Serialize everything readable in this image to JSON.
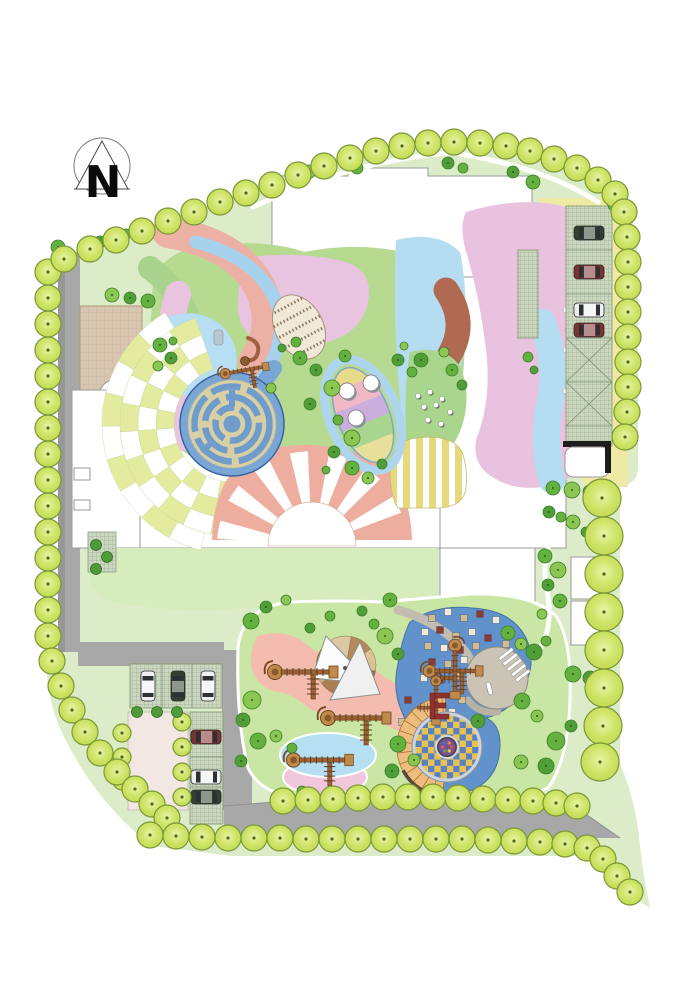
{
  "compass": {
    "label": "N"
  },
  "palette": {
    "background": "#ffffff",
    "lawn_pale": "#dcecc9",
    "lawn_mid": "#c9e6a4",
    "lawn_band": "#b5da90",
    "road_gray": "#a8a8a8",
    "building_white": "#ffffff",
    "salmon": "#ecb1a4",
    "pink_lavender": "#e9c2e0",
    "pale_blue": "#b5ddf1",
    "play_blue": "#6292cc",
    "maze_blue": "#6f9ccb",
    "sienna": "#b06a52",
    "yellow_band": "#efe9a6",
    "stripe_yellow": "#e7d97e",
    "tan_plaza": "#d9c6b0",
    "sand_tan": "#d8cfa5",
    "amphitheater_orange": "#eebd7d",
    "checker_yellow": "#e8c44c",
    "checker_blue": "#5b7fc0",
    "tree_yellow_green": "#cfe468",
    "tree_outline": "#7c9738",
    "car_colors": {
      "green": "#33402f",
      "red": "#7c3230",
      "white": "#efefef"
    },
    "square_colors": [
      "#f1ead8",
      "#d5bc8c",
      "#8e3a2c"
    ],
    "shrub_greens": [
      "#8bc653",
      "#63b23f",
      "#4f9e38",
      "#a2d468"
    ]
  },
  "features": [
    "north-compass",
    "perimeter-tree-rows",
    "ring-road",
    "grass-paver-parking-north-east",
    "grass-paver-parking-south-west",
    "labyrinth-maze",
    "checkerboard-plaza",
    "sunburst-plaza",
    "leaf-mosaic-deck",
    "leaf-stripe-garden",
    "striped-plaza",
    "sand-pit-with-shade-sail",
    "climbing-structures",
    "spiral-amphitheater-checker-circle",
    "toddler-play-lawn",
    "tan-circle-plaza",
    "trellis-strip",
    "pavilion"
  ],
  "trees": {
    "perimeter_r": 13,
    "groups": {
      "left_column": [
        [
          48,
          272
        ],
        [
          48,
          298
        ],
        [
          48,
          324
        ],
        [
          48,
          350
        ],
        [
          48,
          376
        ],
        [
          48,
          402
        ],
        [
          48,
          428
        ],
        [
          48,
          454
        ],
        [
          48,
          480
        ],
        [
          48,
          506
        ],
        [
          48,
          532
        ],
        [
          48,
          558
        ],
        [
          48,
          584
        ],
        [
          48,
          610
        ],
        [
          48,
          636
        ]
      ],
      "bottom_left_curve": [
        [
          52,
          661
        ],
        [
          61,
          686
        ],
        [
          72,
          710
        ],
        [
          85,
          732
        ],
        [
          100,
          753
        ],
        [
          117,
          772
        ],
        [
          135,
          789
        ],
        [
          152,
          804
        ],
        [
          167,
          818
        ]
      ],
      "bottom_row": [
        [
          150,
          835
        ],
        [
          176,
          836
        ],
        [
          202,
          837
        ],
        [
          228,
          838
        ],
        [
          254,
          838
        ],
        [
          280,
          838
        ],
        [
          306,
          839
        ],
        [
          332,
          839
        ],
        [
          358,
          839
        ],
        [
          384,
          839
        ],
        [
          410,
          839
        ],
        [
          436,
          839
        ],
        [
          462,
          839
        ],
        [
          488,
          840
        ],
        [
          514,
          841
        ],
        [
          540,
          842
        ],
        [
          565,
          844
        ],
        [
          587,
          848
        ]
      ],
      "tail": [
        [
          603,
          859
        ],
        [
          617,
          876
        ],
        [
          630,
          892
        ]
      ],
      "upper_row": [
        [
          283,
          801
        ],
        [
          308,
          800
        ],
        [
          333,
          799
        ],
        [
          358,
          798
        ],
        [
          383,
          797
        ],
        [
          408,
          797
        ],
        [
          433,
          797
        ],
        [
          458,
          798
        ],
        [
          483,
          799
        ],
        [
          508,
          800
        ],
        [
          533,
          801
        ],
        [
          556,
          803
        ],
        [
          577,
          806
        ]
      ],
      "top_left_diagonal": [
        [
          64,
          259
        ],
        [
          90,
          249
        ],
        [
          116,
          240
        ],
        [
          142,
          231
        ],
        [
          168,
          221
        ],
        [
          194,
          212
        ],
        [
          220,
          202
        ],
        [
          246,
          193
        ]
      ],
      "top_arc": [
        [
          272,
          185
        ],
        [
          298,
          175
        ],
        [
          324,
          166
        ],
        [
          350,
          158
        ],
        [
          376,
          151
        ],
        [
          402,
          146
        ],
        [
          428,
          143
        ],
        [
          454,
          142
        ],
        [
          480,
          143
        ],
        [
          506,
          146
        ],
        [
          530,
          151
        ],
        [
          554,
          159
        ],
        [
          577,
          168
        ],
        [
          598,
          180
        ],
        [
          615,
          194
        ]
      ],
      "right_column": [
        [
          624,
          212
        ],
        [
          627,
          237
        ],
        [
          628,
          262
        ],
        [
          628,
          287
        ],
        [
          628,
          312
        ],
        [
          628,
          337
        ],
        [
          628,
          362
        ],
        [
          628,
          387
        ],
        [
          627,
          412
        ],
        [
          625,
          437
        ]
      ]
    },
    "right_big": {
      "r": 19,
      "pts": [
        [
          602,
          498
        ],
        [
          604,
          536
        ],
        [
          604,
          574
        ],
        [
          604,
          612
        ],
        [
          604,
          650
        ],
        [
          604,
          688
        ],
        [
          603,
          726
        ],
        [
          600,
          762
        ]
      ]
    },
    "inner_yellow": {
      "r": 9,
      "pts": [
        [
          122,
          733
        ],
        [
          122,
          757
        ],
        [
          122,
          781
        ],
        [
          182,
          722
        ],
        [
          182,
          747
        ],
        [
          182,
          772
        ],
        [
          182,
          797
        ]
      ]
    },
    "dark_small": {
      "r": 5.5,
      "pts": [
        [
          137,
          712
        ],
        [
          157,
          712
        ],
        [
          177,
          712
        ],
        [
          96,
          545
        ],
        [
          107,
          557
        ],
        [
          96,
          569
        ]
      ]
    },
    "scatter": [
      [
        357,
        168,
        6,
        1
      ],
      [
        448,
        163,
        6,
        2
      ],
      [
        463,
        168,
        5,
        1
      ],
      [
        513,
        172,
        6,
        2
      ],
      [
        533,
        182,
        7,
        1
      ],
      [
        308,
        172,
        7,
        0
      ],
      [
        291,
        178,
        5,
        2
      ],
      [
        100,
        242,
        6,
        2
      ],
      [
        126,
        234,
        5,
        1
      ],
      [
        58,
        247,
        7,
        1
      ],
      [
        112,
        295,
        7,
        0
      ],
      [
        130,
        298,
        6,
        2
      ],
      [
        148,
        301,
        7,
        1
      ],
      [
        160,
        345,
        7,
        1
      ],
      [
        171,
        358,
        6,
        2
      ],
      [
        158,
        366,
        5,
        0
      ],
      [
        173,
        341,
        4,
        1
      ],
      [
        300,
        358,
        7,
        1
      ],
      [
        316,
        370,
        6,
        2
      ],
      [
        332,
        388,
        8,
        0
      ],
      [
        345,
        356,
        6,
        1
      ],
      [
        310,
        404,
        6,
        2
      ],
      [
        296,
        342,
        5,
        1
      ],
      [
        282,
        348,
        4,
        2
      ],
      [
        271,
        388,
        5,
        0
      ],
      [
        338,
        420,
        5,
        1
      ],
      [
        352,
        438,
        8,
        0
      ],
      [
        334,
        452,
        6,
        2
      ],
      [
        352,
        468,
        7,
        1
      ],
      [
        368,
        478,
        6,
        0
      ],
      [
        382,
        464,
        5,
        2
      ],
      [
        326,
        470,
        4,
        1
      ],
      [
        398,
        360,
        6,
        2
      ],
      [
        412,
        372,
        5,
        1
      ],
      [
        404,
        346,
        4,
        0
      ],
      [
        421,
        360,
        7,
        2
      ],
      [
        452,
        370,
        6,
        1
      ],
      [
        462,
        385,
        5,
        2
      ],
      [
        444,
        352,
        5,
        0
      ],
      [
        553,
        488,
        7,
        1
      ],
      [
        572,
        490,
        8,
        0
      ],
      [
        590,
        492,
        7,
        2
      ],
      [
        549,
        512,
        6,
        2
      ],
      [
        561,
        517,
        5,
        1
      ],
      [
        573,
        522,
        7,
        0
      ],
      [
        586,
        532,
        5,
        2
      ],
      [
        545,
        556,
        7,
        1
      ],
      [
        558,
        570,
        8,
        0
      ],
      [
        548,
        585,
        6,
        2
      ],
      [
        560,
        601,
        7,
        1
      ],
      [
        542,
        614,
        5,
        0
      ],
      [
        573,
        674,
        8,
        1
      ],
      [
        590,
        678,
        7,
        2
      ],
      [
        251,
        621,
        8,
        1
      ],
      [
        266,
        607,
        6,
        2
      ],
      [
        286,
        600,
        5,
        0
      ],
      [
        390,
        600,
        7,
        1
      ],
      [
        362,
        611,
        5,
        2
      ],
      [
        330,
        616,
        5,
        1
      ],
      [
        385,
        636,
        8,
        0
      ],
      [
        398,
        654,
        6,
        2
      ],
      [
        374,
        624,
        5,
        1
      ],
      [
        310,
        628,
        5,
        2
      ],
      [
        508,
        633,
        7,
        1
      ],
      [
        521,
        644,
        6,
        0
      ],
      [
        534,
        652,
        8,
        2
      ],
      [
        546,
        641,
        5,
        1
      ],
      [
        252,
        700,
        9,
        0
      ],
      [
        243,
        720,
        7,
        2
      ],
      [
        258,
        741,
        8,
        1
      ],
      [
        241,
        761,
        6,
        2
      ],
      [
        276,
        736,
        6,
        0
      ],
      [
        292,
        748,
        5,
        1
      ],
      [
        398,
        744,
        8,
        1
      ],
      [
        414,
        760,
        6,
        0
      ],
      [
        392,
        771,
        7,
        2
      ],
      [
        302,
        791,
        5,
        1
      ],
      [
        478,
        721,
        7,
        2
      ],
      [
        522,
        701,
        8,
        1
      ],
      [
        537,
        716,
        6,
        0
      ],
      [
        556,
        741,
        9,
        1
      ],
      [
        571,
        726,
        6,
        2
      ],
      [
        521,
        762,
        7,
        0
      ],
      [
        546,
        766,
        8,
        2
      ],
      [
        528,
        357,
        5,
        1
      ],
      [
        534,
        370,
        4,
        2
      ],
      [
        614,
        205,
        6,
        1
      ]
    ]
  },
  "cars": [
    {
      "x": 589,
      "y": 233,
      "rot": 0,
      "c": "green"
    },
    {
      "x": 589,
      "y": 272,
      "rot": 0,
      "c": "red"
    },
    {
      "x": 589,
      "y": 310,
      "rot": 0,
      "c": "white"
    },
    {
      "x": 589,
      "y": 330,
      "rot": 0,
      "c": "red"
    },
    {
      "x": 148,
      "y": 686,
      "rot": 90,
      "c": "white"
    },
    {
      "x": 178,
      "y": 686,
      "rot": 90,
      "c": "green"
    },
    {
      "x": 208,
      "y": 686,
      "rot": 90,
      "c": "white"
    },
    {
      "x": 206,
      "y": 737,
      "rot": 0,
      "c": "red"
    },
    {
      "x": 206,
      "y": 777,
      "rot": 0,
      "c": "white"
    },
    {
      "x": 206,
      "y": 797,
      "rot": 0,
      "c": "green"
    }
  ],
  "play_squares": [
    [
      432,
      618,
      1
    ],
    [
      448,
      612,
      0
    ],
    [
      464,
      618,
      1
    ],
    [
      480,
      614,
      2
    ],
    [
      496,
      620,
      0
    ],
    [
      425,
      632,
      0
    ],
    [
      440,
      630,
      2
    ],
    [
      456,
      636,
      1
    ],
    [
      472,
      632,
      0
    ],
    [
      488,
      638,
      2
    ],
    [
      428,
      646,
      1
    ],
    [
      444,
      648,
      0
    ],
    [
      460,
      650,
      2
    ],
    [
      476,
      646,
      1
    ],
    [
      492,
      652,
      0
    ],
    [
      506,
      644,
      1
    ],
    [
      432,
      662,
      2
    ],
    [
      448,
      664,
      1
    ],
    [
      464,
      660,
      0
    ],
    [
      480,
      666,
      2
    ],
    [
      424,
      678,
      0
    ],
    [
      440,
      680,
      2
    ],
    [
      456,
      676,
      1
    ],
    [
      496,
      674,
      0
    ],
    [
      408,
      700,
      2
    ],
    [
      416,
      712,
      0
    ],
    [
      402,
      722,
      1
    ],
    [
      462,
      700,
      1
    ],
    [
      452,
      712,
      0
    ]
  ],
  "checker_plaza": {
    "cx": 232,
    "cy": 424,
    "step": 15,
    "colors": [
      "#e3ec9e",
      "#ffffff"
    ],
    "rings": [
      {
        "r0": 58,
        "r1": 76,
        "a0": 86,
        "a1": 251
      },
      {
        "r0": 76,
        "r1": 94,
        "a0": 86,
        "a1": 251
      },
      {
        "r0": 94,
        "r1": 112,
        "a0": 86,
        "a1": 251
      },
      {
        "r0": 112,
        "r1": 130,
        "a0": 104,
        "a1": 239
      }
    ]
  },
  "sunburst": {
    "cx": 312,
    "cy": 546,
    "r_in": 44,
    "r_out": 95,
    "rays": [
      190,
      214,
      238,
      262,
      286,
      310,
      334
    ],
    "ray_w": 11,
    "ray_color": "#ffffff"
  },
  "sandpit": {
    "cx": 346,
    "cy": 666,
    "r": 30,
    "start": -80,
    "colors": [
      "#b5895c",
      "#dcc394",
      "#93714e",
      "#e3d4b4",
      "#a97e52",
      "#cfb285",
      "#8a684a",
      "#dbc9a5"
    ]
  },
  "target": {
    "cx": 447,
    "cy": 747,
    "r_checker": 31.5,
    "cell": 6.3,
    "ring_fill": "#ccd3da",
    "ring_stroke": "#8b95a0",
    "amphitheater": {
      "r0": 34,
      "r1": 50,
      "a0": 95,
      "a1": 268,
      "step": 13,
      "fill": "#eebd7d",
      "stroke": "#a8702f"
    },
    "dark_arc": {
      "r0": 48,
      "r1": 51.5,
      "a0": 95,
      "a1": 152,
      "fill": "#5a483a"
    },
    "center": {
      "r_outer": 11,
      "r_inner": 8.5,
      "outer_fill": "#404552",
      "inner_fill": "#7b4f92",
      "dot_colors": [
        "#d94f3f",
        "#e8c04a",
        "#58a64b",
        "#cc5f8a",
        "#4a72b8",
        "#e0883f"
      ]
    }
  },
  "stairs": {
    "x0": 506,
    "y0": 654,
    "dx": 4.2,
    "dy": 5.4,
    "n": 5,
    "len": 17,
    "rot": -38
  },
  "structures": [
    {
      "x": 305,
      "y": 672,
      "rot": 0,
      "s": 1
    },
    {
      "x": 358,
      "y": 718,
      "rot": 0,
      "s": 1
    },
    {
      "x": 322,
      "y": 760,
      "rot": 0,
      "s": 0.95
    },
    {
      "x": 246,
      "y": 370,
      "rot": -10,
      "s": 0.7
    },
    {
      "x": 455,
      "y": 671,
      "rot": 0,
      "s": 0.85
    },
    {
      "x": 455,
      "y": 671,
      "rot": 90,
      "s": 0.85
    },
    {
      "x": 436,
      "y": 702,
      "rot": 90,
      "s": 0.7
    }
  ],
  "stepping_stones": {
    "green_area": [
      [
        418,
        396
      ],
      [
        430,
        392
      ],
      [
        442,
        399
      ],
      [
        424,
        407
      ],
      [
        436,
        405
      ],
      [
        450,
        412
      ],
      [
        428,
        420
      ],
      [
        441,
        424
      ]
    ],
    "pink_area": [
      [
        566,
        310
      ],
      [
        568,
        330
      ],
      [
        566,
        350
      ],
      [
        569,
        371
      ],
      [
        566,
        391
      ]
    ]
  },
  "seats_white": [
    [
      347,
      391
    ],
    [
      371,
      383
    ],
    [
      356,
      418
    ]
  ]
}
